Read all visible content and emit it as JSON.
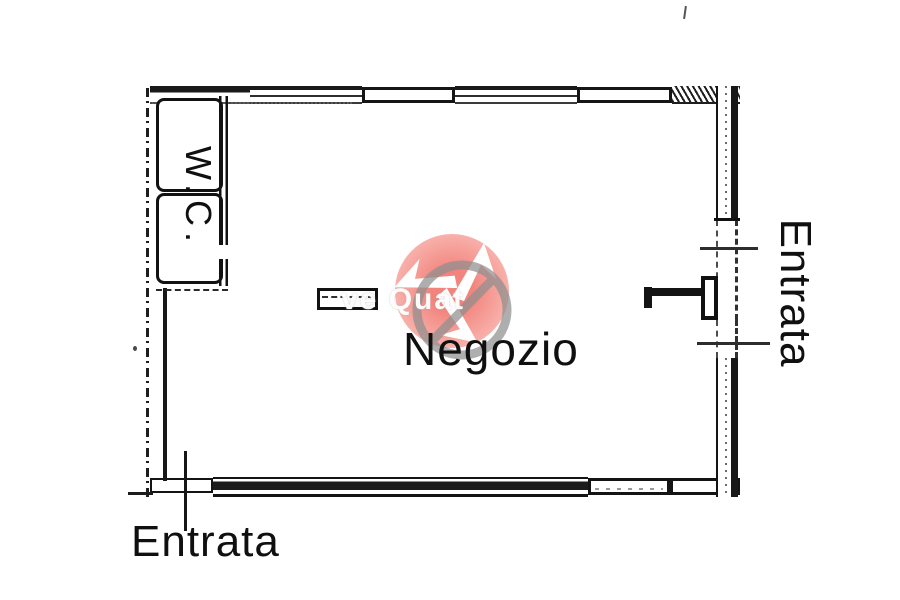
{
  "plan": {
    "room_label": "Negozio",
    "wc_label": "W.C.",
    "entrance_right_label": "Entrata",
    "entrance_bottom_label": "Entrata"
  },
  "watermark": {
    "text_fragment": "ve Quat",
    "circle_color": "#ef6e66",
    "circle_edge_color": "#f7a39c",
    "ring_color": "#8f8f8f",
    "arrow_color": "#ffffff"
  },
  "colors": {
    "line": "#141414",
    "background": "#ffffff"
  }
}
